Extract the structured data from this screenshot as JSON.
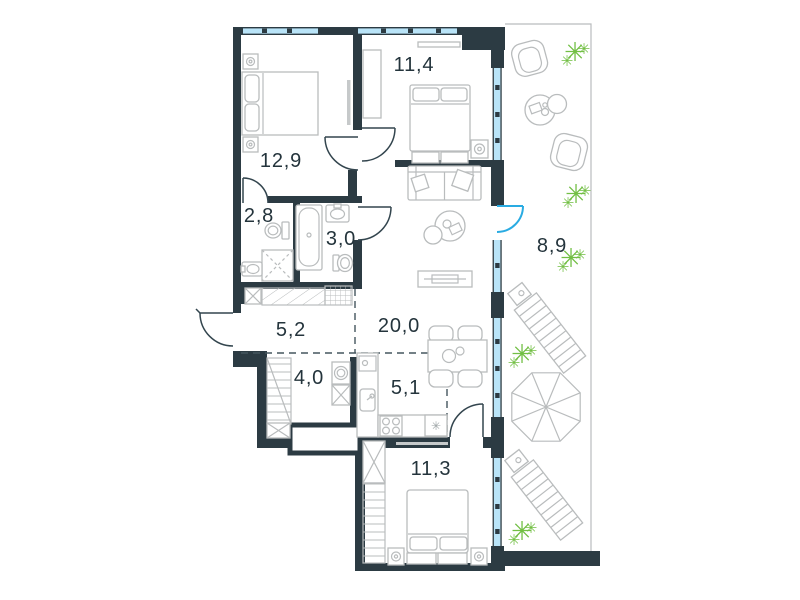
{
  "plan": {
    "type": "apartment-floor-plan",
    "rooms": [
      {
        "id": "bedroom-1",
        "area": "12,9"
      },
      {
        "id": "bedroom-2",
        "area": "11,4"
      },
      {
        "id": "bathroom-1",
        "area": "2,8"
      },
      {
        "id": "bathroom-2",
        "area": "3,0"
      },
      {
        "id": "terrace",
        "area": "8,9"
      },
      {
        "id": "hallway",
        "area": "5,2"
      },
      {
        "id": "living-room",
        "area": "20,0"
      },
      {
        "id": "storage",
        "area": "4,0"
      },
      {
        "id": "kitchen",
        "area": "5,1"
      },
      {
        "id": "bedroom-3",
        "area": "11,3"
      }
    ],
    "colors": {
      "wall": "#2c3b43",
      "window_glass": "#b9e4f8",
      "balcony_door_accent": "#29abe2",
      "furniture_outline": "#b9bcbd",
      "dashed_zone_line": "#45565e",
      "plant_green": "#72bf44",
      "label_text": "#24343c",
      "background": "#ffffff"
    },
    "icons": [
      "snowflake-icon",
      "plant-icon"
    ]
  }
}
